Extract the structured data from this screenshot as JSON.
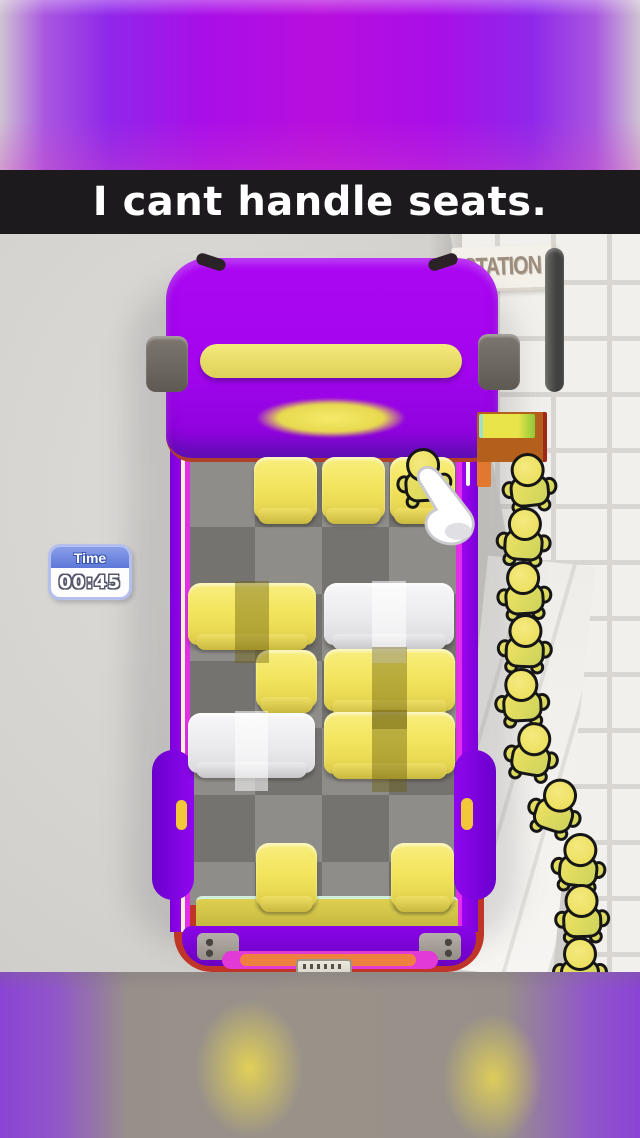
{
  "caption": {
    "text": "I cant handle seats."
  },
  "hud": {
    "timer": {
      "label": "Time",
      "value": "00:45"
    }
  },
  "station": {
    "sign": "STATION"
  },
  "colors": {
    "bus_purple": "#a305ee",
    "bus_outline_magenta": "#e22ee8",
    "bus_rear_red": "#bf3528",
    "seat_yellow": "#f3e55f",
    "seat_white": "#ececef",
    "character_yellow": "#e9dd5d",
    "caption_bg": "#1d1a1d",
    "timer_blue": "#5c77d8",
    "floor_dark": "#757370",
    "floor_light": "#8f8d89",
    "tile_white": "#f2f0ec"
  },
  "bus": {
    "grid": {
      "cols": 4,
      "rows": 7
    },
    "seats": [
      {
        "x": 254,
        "y": 457,
        "w": 63,
        "h": 62,
        "kind": "single",
        "color": "yellow",
        "occupied": false
      },
      {
        "x": 322,
        "y": 457,
        "w": 63,
        "h": 62,
        "kind": "single",
        "color": "yellow",
        "occupied": false
      },
      {
        "x": 390,
        "y": 457,
        "w": 65,
        "h": 62,
        "kind": "single",
        "color": "yellow",
        "occupied": true
      },
      {
        "x": 188,
        "y": 583,
        "w": 128,
        "h": 62,
        "kind": "double",
        "color": "yellow",
        "occupied": false
      },
      {
        "x": 324,
        "y": 583,
        "w": 130,
        "h": 62,
        "kind": "double",
        "color": "white",
        "occupied": false
      },
      {
        "x": 256,
        "y": 650,
        "w": 61,
        "h": 58,
        "kind": "single",
        "color": "yellow",
        "occupied": false
      },
      {
        "x": 324,
        "y": 649,
        "w": 131,
        "h": 62,
        "kind": "double",
        "color": "yellow",
        "occupied": false
      },
      {
        "x": 188,
        "y": 713,
        "w": 127,
        "h": 60,
        "kind": "double",
        "color": "white",
        "occupied": false
      },
      {
        "x": 324,
        "y": 712,
        "w": 131,
        "h": 62,
        "kind": "double",
        "color": "yellow",
        "occupied": false
      },
      {
        "x": 256,
        "y": 843,
        "w": 61,
        "h": 64,
        "kind": "single",
        "color": "yellow",
        "occupied": false
      },
      {
        "x": 391,
        "y": 843,
        "w": 63,
        "h": 64,
        "kind": "single",
        "color": "yellow",
        "occupied": false
      }
    ],
    "seated_passenger": {
      "x": 424,
      "y": 467,
      "r": -4
    }
  },
  "queue": {
    "count": 10,
    "passengers": [
      {
        "x": 529,
        "y": 472,
        "r": -6
      },
      {
        "x": 524,
        "y": 526,
        "r": 4
      },
      {
        "x": 524,
        "y": 580,
        "r": -4
      },
      {
        "x": 525,
        "y": 633,
        "r": 2
      },
      {
        "x": 522,
        "y": 687,
        "r": -3
      },
      {
        "x": 532,
        "y": 741,
        "r": 10
      },
      {
        "x": 556,
        "y": 797,
        "r": 18
      },
      {
        "x": 579,
        "y": 852,
        "r": 6
      },
      {
        "x": 582,
        "y": 903,
        "r": -2
      },
      {
        "x": 580,
        "y": 956,
        "r": 0
      }
    ]
  },
  "cursor": {
    "x": 404,
    "y": 462
  }
}
